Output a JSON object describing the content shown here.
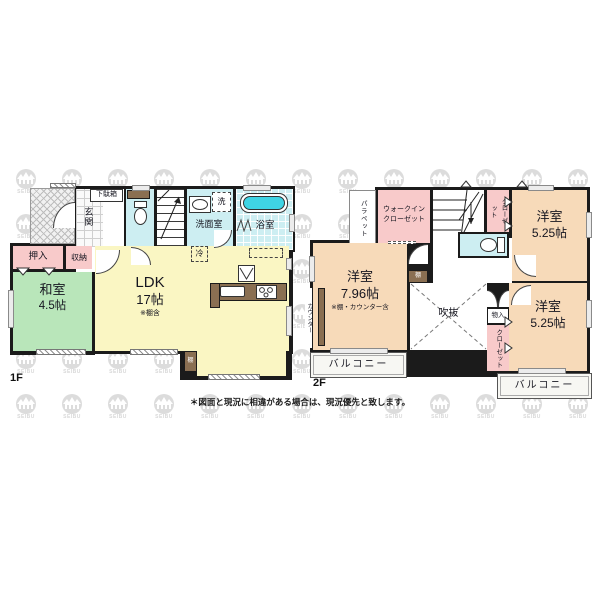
{
  "watermark_text": "SEIBU",
  "footnote": "＊図面と現況に相違がある場合は、現況優先と致します。",
  "colors": {
    "wall": "#1b1b1b",
    "tatami_green": "#b9e6ba",
    "ldk_yellow": "#faf6c3",
    "wet_cyan": "#cdeef2",
    "closet_pink": "#f8caca",
    "western_orange": "#f7dab9",
    "wood_brown": "#8a6f52",
    "bathtub_cyan": "#3fd4e4"
  },
  "floor1": {
    "label": "1F",
    "genkan": "玄関",
    "getabako": "下駄箱",
    "senmenshitsu": "洗面室",
    "sentakuki": "洗",
    "yokushitsu": "浴室",
    "reizoko": "冷",
    "oshiire": "押入",
    "shunou": "収納",
    "washitsu_name": "和室",
    "washitsu_size": "4.5帖",
    "ldk_name": "LDK",
    "ldk_size": "17帖",
    "ldk_note": "※棚含",
    "tana": "棚"
  },
  "floor2": {
    "label": "2F",
    "parapet": "パラペット",
    "wic_line1": "ウォークイン",
    "wic_line2": "クローゼット",
    "closet_top": "クローゼット",
    "room_tr_name": "洋室",
    "room_tr_size": "5.25帖",
    "room_l_name": "洋室",
    "room_l_size": "7.96帖",
    "room_l_note": "※棚・カウンター含",
    "counter": "カウンター",
    "tana": "棚",
    "fukinuke": "吹抜",
    "monoire": "物入",
    "closet_bottom": "クローゼット",
    "room_br_name": "洋室",
    "room_br_size": "5.25帖",
    "balcony_left": "バルコニー",
    "balcony_right": "バルコニー"
  }
}
